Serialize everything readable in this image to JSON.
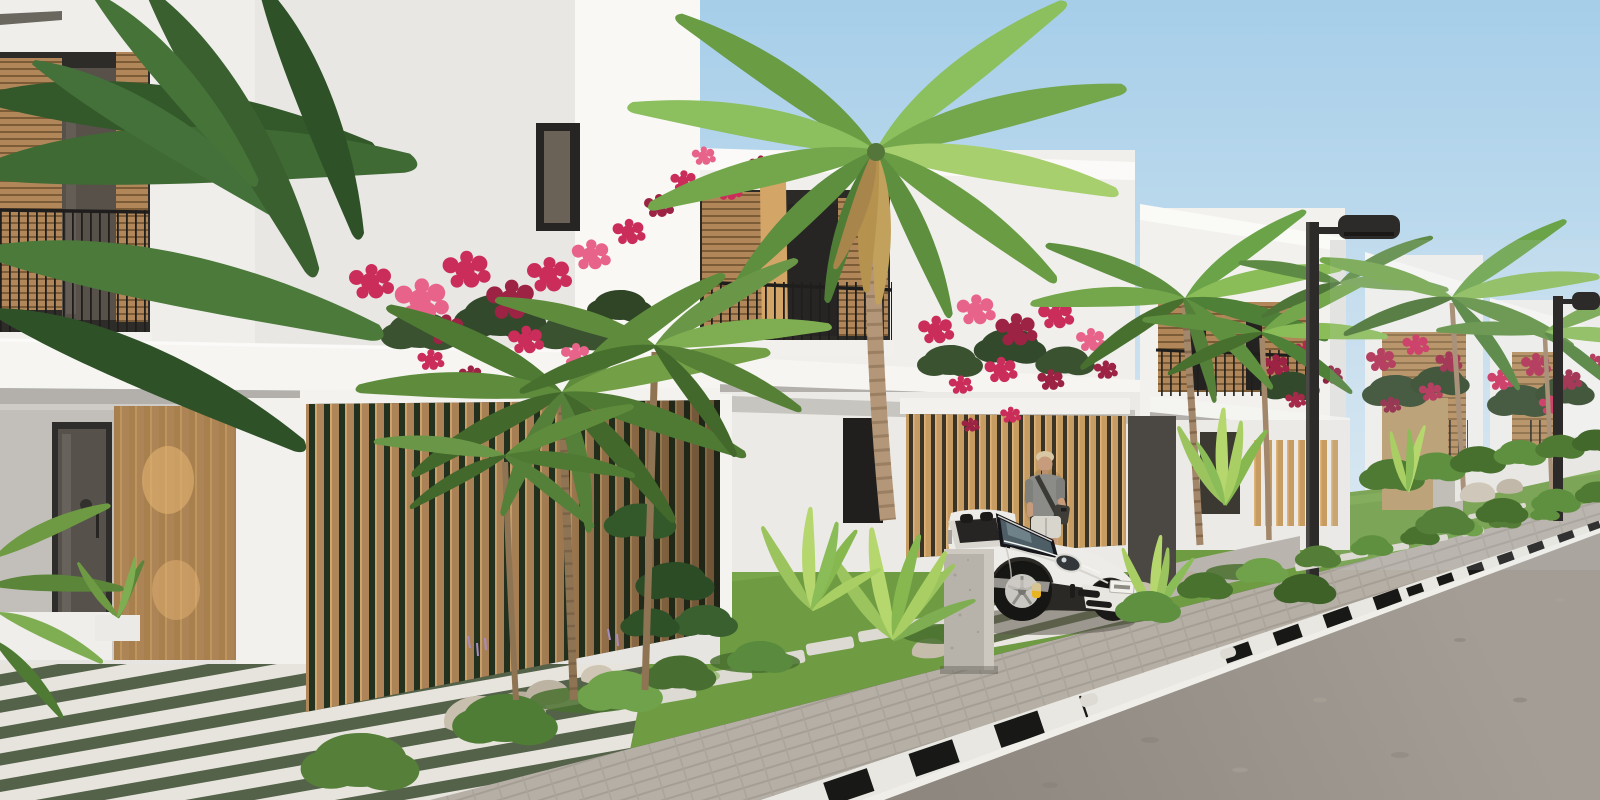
{
  "scene": {
    "title": "Sunny 3D architectural rendering of a modern villa street with palm trees and a white convertible sports car",
    "setting": "Row of white two-storey minimalist villas with wooden slat screens and balconies receding along a paved street under a clear blue sky",
    "time_of_day": "daytime, bright sunlight from the left",
    "objects": {
      "villas": {
        "count_visible": 6,
        "style": "white render, flat roofs, wood louver shutters, black metal balcony railings, white canopy slabs, vertical wood slat fences",
        "landscaping": "bougainvillea in pink and red, palm trees, trimmed bushes, rocks, white stepping stones in grass"
      },
      "car": {
        "type": "white convertible sports car (911-style), top down",
        "details": "yellow brake calipers, dark windshield, black front intakes, white license plate",
        "location": "parked on striped villa driveway facing the street"
      },
      "person": {
        "description": "young man standing behind the car",
        "clothing": "gray t-shirt, light shorts, dark shoulder strap bag, wristwatch"
      },
      "street": {
        "elements": "black-and-white striped curb, white road edge line, gray asphalt, paver parking strip, dark street lamps with flat heads",
        "lamp_count_visible": 2
      }
    }
  },
  "palette": {
    "sky_top": "#a6cee9",
    "sky_horizon": "#dceaf3",
    "wall_bright": "#f9f8f5",
    "wall_light": "#f0efec",
    "wall_mid": "#e7e6e3",
    "canopy_white": "#f6f5f2",
    "soffit": "#b3b0ab",
    "wood": "#b1875a",
    "wood_dark": "#7c5c36",
    "wood_light": "#d5a86d",
    "glass_dark": "#3a3834",
    "frame_dark": "#262523",
    "rail_dark": "#1f1e1d",
    "grass": "#6f9c43",
    "grass_dark": "#597f35",
    "paver": "#b5afa6",
    "road_light": "#a39d95",
    "road_dark": "#8d877f",
    "line_white": "#f0eee9",
    "curb_white": "#e9e7e1",
    "curb_black": "#181816",
    "stone_white": "#dcdad2",
    "concrete": "#b7b3ab",
    "trunk": "#b49678",
    "green_dark": "#3c6630",
    "green_mid": "#5d8f3f",
    "green_light": "#74a74b",
    "green_bright": "#9cc45e",
    "flower_pink": "#cb2d5b",
    "flower_light": "#e8638a",
    "flower_deep": "#9c2344",
    "dry_frond": "#c2a15c",
    "car_white": "#edece8",
    "caliper_yellow": "#e8b421",
    "skin": "#c79c7c",
    "hair": "#d8c7a2",
    "shirt": "#8b8b87",
    "shorts": "#d8d5cd",
    "lamp": "#2c2b29"
  }
}
